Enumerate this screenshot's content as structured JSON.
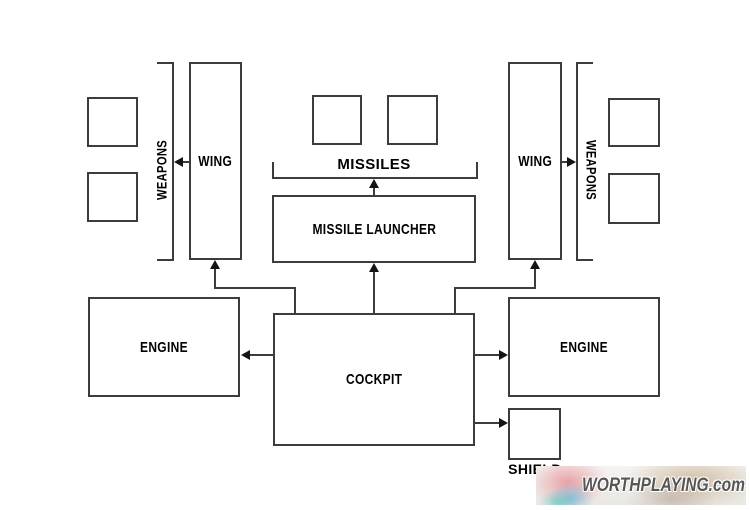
{
  "diagram": {
    "title_implied": "ship component layout",
    "colors": {
      "background": "#ffffff",
      "line": "#3c3c3c",
      "arrow": "#141414",
      "text": "#000000",
      "watermark_text": "#565656"
    },
    "nodes": {
      "wing_left": {
        "label": "WING"
      },
      "wing_right": {
        "label": "WING"
      },
      "weapons_left": {
        "label": "WEAPONS"
      },
      "weapons_right": {
        "label": "WEAPONS"
      },
      "missiles": {
        "label": "MISSILES"
      },
      "missile_launcher": {
        "label": "MISSILE LAUNCHER"
      },
      "engine_left": {
        "label": "ENGINE"
      },
      "engine_right": {
        "label": "ENGINE"
      },
      "cockpit": {
        "label": "COCKPIT"
      },
      "shield": {
        "label": "SHIELD"
      }
    },
    "slots": {
      "weapons_left_boxes": 2,
      "missiles_boxes": 2,
      "weapons_right_boxes": 2
    },
    "edges": [
      {
        "from": "cockpit",
        "to": "engine_left"
      },
      {
        "from": "cockpit",
        "to": "engine_right"
      },
      {
        "from": "cockpit",
        "to": "shield"
      },
      {
        "from": "cockpit",
        "to": "missile_launcher"
      },
      {
        "from": "cockpit",
        "to": "wing_left"
      },
      {
        "from": "cockpit",
        "to": "wing_right"
      },
      {
        "from": "missile_launcher",
        "to": "missiles"
      },
      {
        "from": "wing_left",
        "to": "weapons_left"
      },
      {
        "from": "wing_right",
        "to": "weapons_right"
      }
    ]
  },
  "watermark": {
    "text": "WORTHPLAYING.com"
  }
}
